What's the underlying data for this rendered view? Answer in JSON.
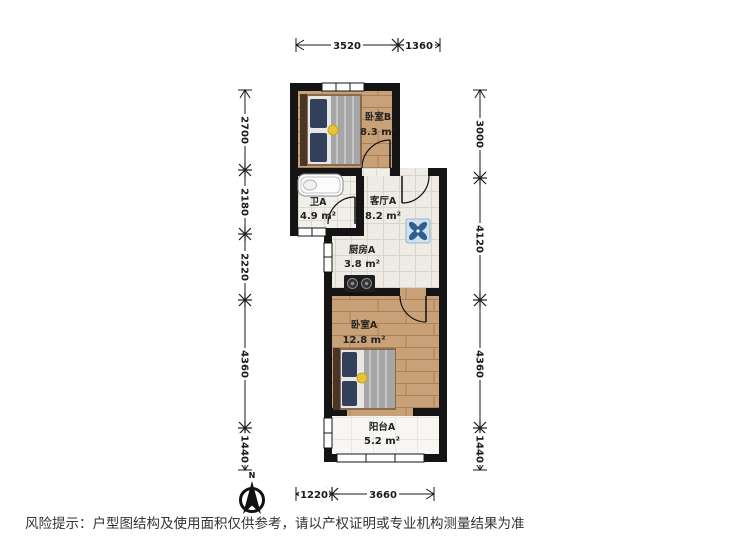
{
  "rooms": [
    {
      "name": "卧室B",
      "area": "8.3 m²"
    },
    {
      "name": "卫A",
      "area": "4.9 m²"
    },
    {
      "name": "客厅A",
      "area": "8.2 m²"
    },
    {
      "name": "厨房A",
      "area": "3.8 m²"
    },
    {
      "name": "卧室A",
      "area": "12.8 m²"
    },
    {
      "name": "阳台A",
      "area": "5.2 m²"
    }
  ],
  "dimensions": {
    "top": [
      "3520",
      "1360"
    ],
    "bottom": [
      "1220",
      "3660"
    ],
    "left": [
      "2700",
      "2180",
      "2220",
      "4360",
      "1440"
    ],
    "right": [
      "3000",
      "4120",
      "4360",
      "1440"
    ]
  },
  "compass": {
    "label": "N"
  },
  "disclaimer": "风险提示：户型图结构及使用面积仅供参考，请以产权证明或专业机构测量结果为准",
  "colors": {
    "wall": "#141414",
    "wood_floor": "#c9a178",
    "tile_floor": "#eeebe5",
    "bed_accent": "#e8c333",
    "ac_blue": "#2d5f8f"
  }
}
